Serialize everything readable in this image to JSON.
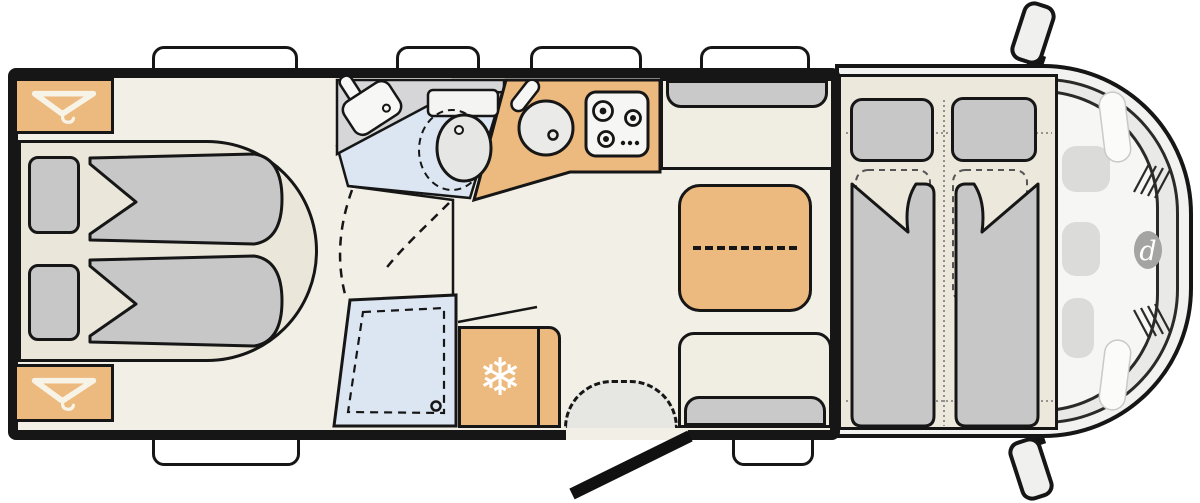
{
  "document": {
    "type": "motorhome floor plan, top view",
    "orientation": "driver cab on the right, rear bedroom on the left"
  },
  "palette": {
    "outline": "#161616",
    "floor_cream": "#f2efe6",
    "furniture_orange": "#ecb97e",
    "cushion_gray": "#c7c7c7",
    "wet_area_blue": "#dbe6f2",
    "counter_gray": "#d6d6d8",
    "bed_base_beige": "#eae7da",
    "vehicle_body": "#f2f2f0",
    "logo_gray": "#a4a4a2",
    "icon_cream": "#f8f3e7"
  },
  "glyphs": {
    "snowflake": "❄",
    "brand_letter": "d"
  },
  "zones": {
    "rear_bedroom": {
      "items": [
        "wardrobe top-left",
        "wardrobe bottom-left",
        "two single beds",
        "pillows",
        "folded duvets"
      ]
    },
    "bathroom": {
      "items": [
        "corner washbasin",
        "toilet",
        "shower cubicle with drain",
        "door swing arcs"
      ]
    },
    "kitchen": {
      "items": [
        "round sink with tap",
        "3-burner hob with knobs",
        "refrigerator with snowflake"
      ]
    },
    "dinette": {
      "items": [
        "wall bench",
        "facing bench",
        "extendable table with fold line"
      ]
    },
    "cab": {
      "items": [
        "drop-down bed with two pillows and duvets",
        "dashed pilot-seat outlines",
        "windscreen",
        "dashboard",
        "front grille",
        "brand logo",
        "two wing mirrors"
      ]
    },
    "openings": {
      "roof_windows_top": 4,
      "windows_bottom": 2,
      "entrance_door_bottom": 1,
      "door_step": 1
    }
  }
}
